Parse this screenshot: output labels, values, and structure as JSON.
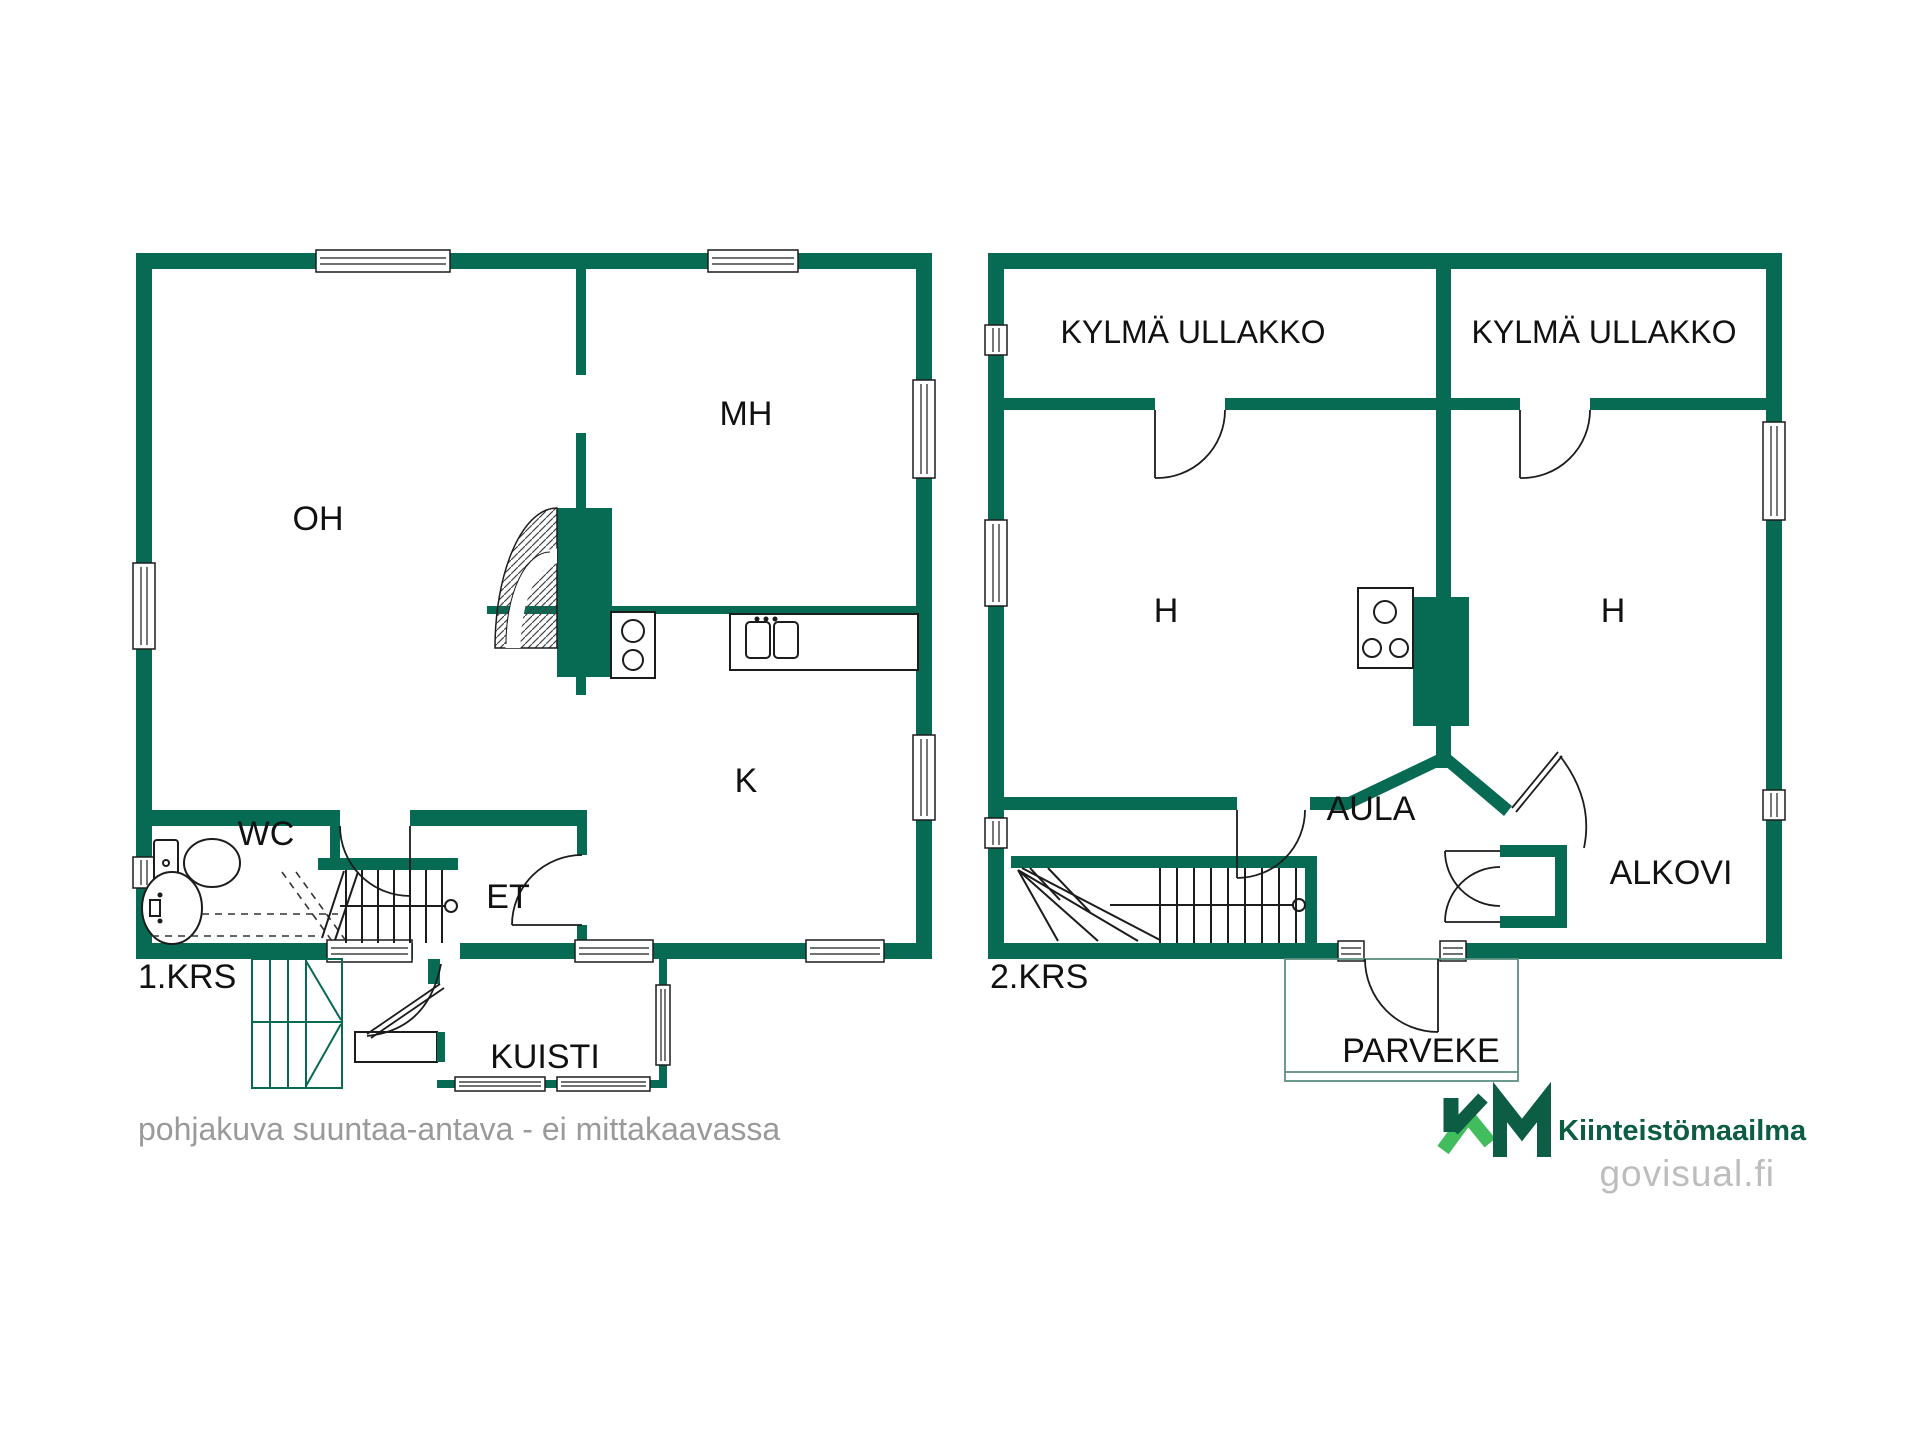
{
  "floor1": {
    "label": "1.KRS",
    "rooms": {
      "oh": "OH",
      "mh": "MH",
      "k": "K",
      "wc": "WC",
      "et": "ET",
      "kuisti": "KUISTI"
    }
  },
  "floor2": {
    "label": "2.KRS",
    "rooms": {
      "attic_left": "KYLMÄ ULLAKKO",
      "attic_right": "KYLMÄ ULLAKKO",
      "h_left": "H",
      "h_right": "H",
      "aula": "AULA",
      "alkovi": "ALKOVI",
      "parveke": "PARVEKE"
    }
  },
  "footer": {
    "disclaimer": "pohjakuva suuntaa-antava - ei mittakaavassa"
  },
  "logo": {
    "monogram": "KM",
    "name": "Kiinteistömaailma",
    "site": "govisual.fi"
  },
  "colors": {
    "wall_green": "#076a53",
    "line_black": "#1c1c1c",
    "logo_dark_green": "#0d5c44",
    "logo_light_green": "#41bd5e",
    "disclaimer_gray": "#9a9a9a",
    "site_gray": "#bdbdbd"
  }
}
